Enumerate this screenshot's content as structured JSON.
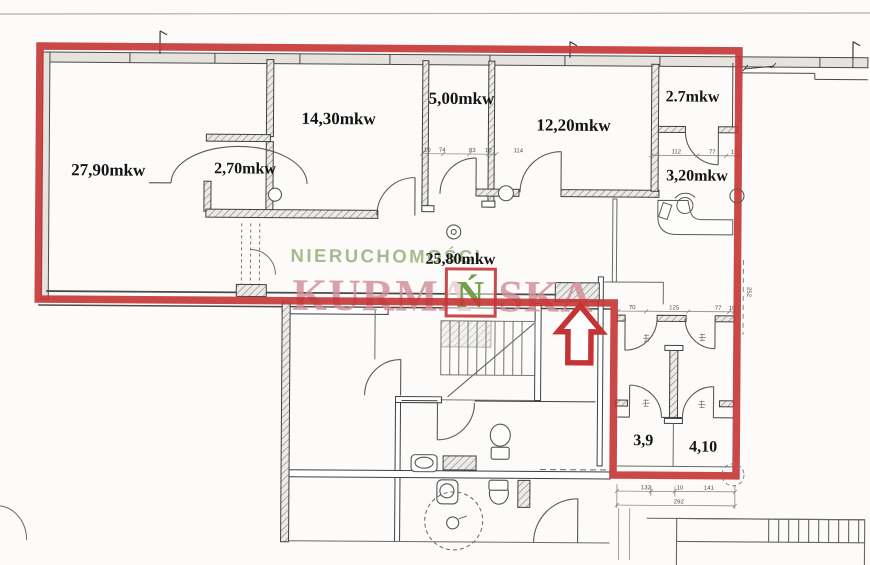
{
  "watermark": {
    "top_text": "NIERUCHOMOŚCI",
    "brand_left": "KURMA",
    "logo_letter": "Ń",
    "brand_right": "SKA",
    "top_color": "#a6bb8d",
    "brand_color": "#cf8e98",
    "logo_letter_color": "#72a04c",
    "logo_border_color": "#c64b4b"
  },
  "outline": {
    "color": "#c43434"
  },
  "rooms": [
    {
      "id": "room-27-90",
      "label": "27,90mkw"
    },
    {
      "id": "closet-2-70",
      "label": "2,70mkw"
    },
    {
      "id": "room-14-30",
      "label": "14,30mkw"
    },
    {
      "id": "room-5-00",
      "label": "5,00mkw"
    },
    {
      "id": "room-12-20",
      "label": "12,20mkw"
    },
    {
      "id": "room-2-7",
      "label": "2.7mkw"
    },
    {
      "id": "room-3-20",
      "label": "3,20mkw"
    },
    {
      "id": "hall-25-80",
      "label": "25,80mkw"
    },
    {
      "id": "wc-3-9",
      "label": "3,9"
    },
    {
      "id": "wc-4-10",
      "label": "4,10"
    }
  ],
  "dimensions": {
    "door_row_left": [
      "10",
      "74",
      "83",
      "10",
      "114"
    ],
    "door_row_right": [
      "112",
      "77",
      "10"
    ],
    "wc_top": [
      "70",
      "125",
      "77",
      "10"
    ],
    "wc_bottom": [
      "132",
      "10",
      "141"
    ],
    "wc_total": "292",
    "side_vertical": "252"
  }
}
